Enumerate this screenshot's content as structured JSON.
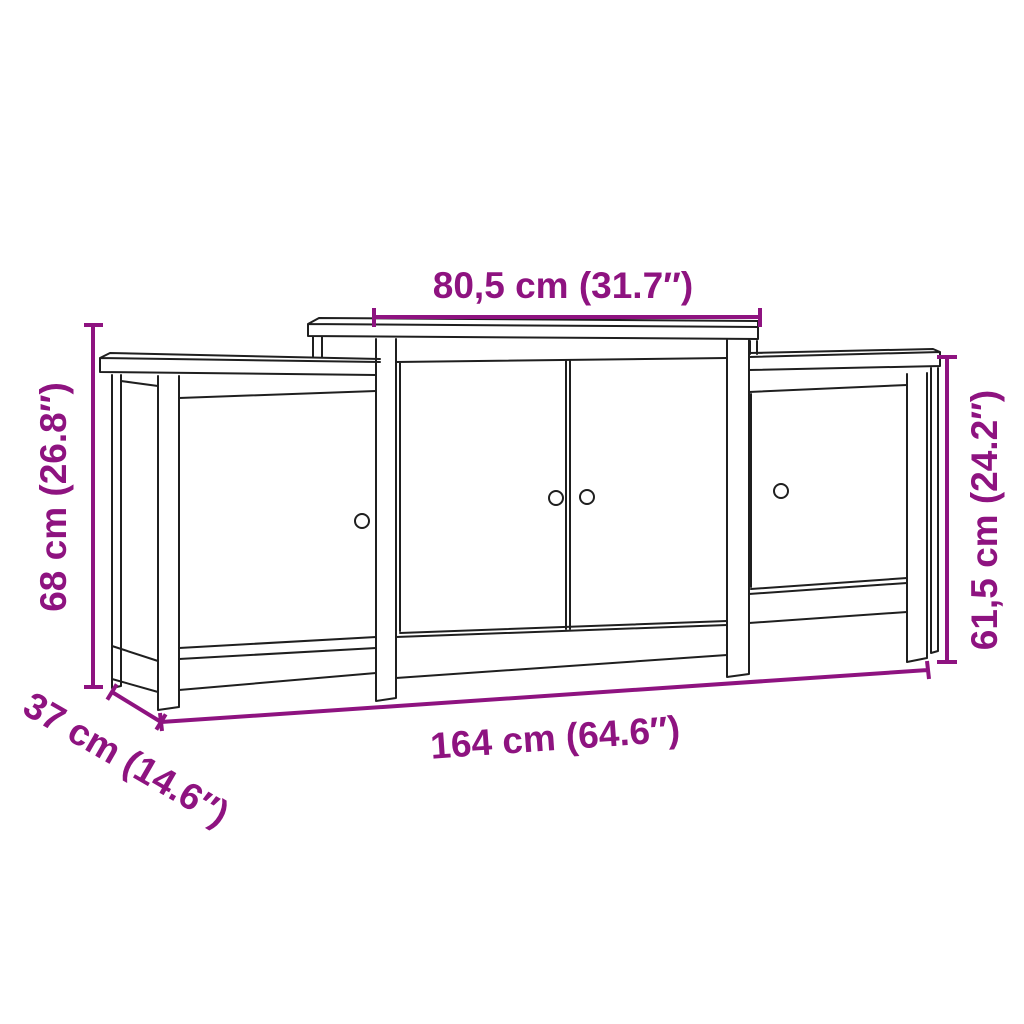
{
  "diagram": {
    "title": "sideboard-dimension-diagram",
    "colors": {
      "dimension": "#8E1380",
      "line_art": "#1f1f1f",
      "background": "#ffffff"
    },
    "dimensions": {
      "top_width": "80,5 cm (31.7″)",
      "left_height": "68 cm (26.8″)",
      "right_height": "61,5 cm (24.2″)",
      "bottom_width": "164 cm (64.6″)",
      "depth": "37 cm (14.6″)"
    }
  }
}
